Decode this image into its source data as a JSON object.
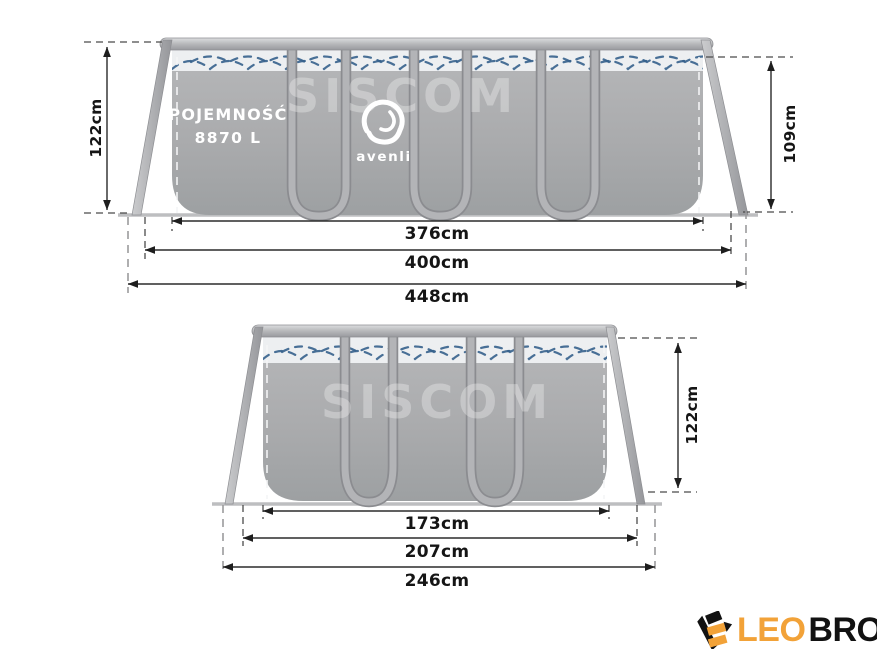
{
  "colors": {
    "accent": "#f2a238",
    "ink": "#121212",
    "wave": "#35608c",
    "dim": "#2b2b2b",
    "pool_gray": "#abacae",
    "water_band": "#edeff1"
  },
  "side_view": {
    "capacity_line1": "POJEMNOŚĆ",
    "capacity_line2": "8870 L",
    "brand": "avenli",
    "watermark": "SISCOM",
    "height_left": "122cm",
    "height_right": "109cm",
    "width_water": "376cm",
    "width_frame": "400cm",
    "width_total": "448cm"
  },
  "end_view": {
    "watermark": "SISCOM",
    "height_right": "122cm",
    "width_water": "173cm",
    "width_frame": "207cm",
    "width_total": "246cm"
  },
  "brandmark": {
    "primary": "LEO",
    "secondary": "BRO"
  }
}
